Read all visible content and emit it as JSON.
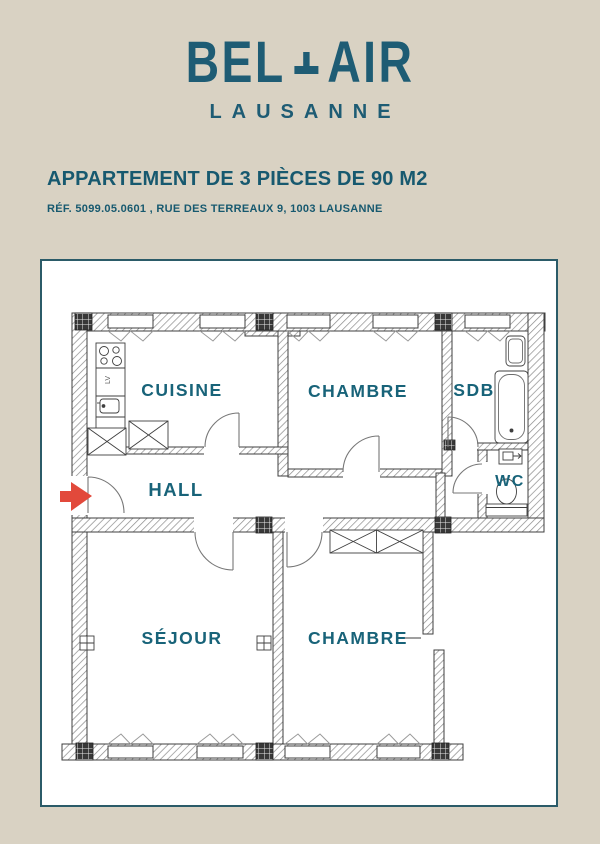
{
  "brand": {
    "name_left": "BEL",
    "name_right": "AIR",
    "city": "LAUSANNE"
  },
  "listing": {
    "title": "APPARTEMENT DE 3 PIÈCES DE 90 M2",
    "reference": "RÉF. 5099.05.0601 , RUE DES TERREAUX 9, 1003 LAUSANNE"
  },
  "plan": {
    "rooms": [
      {
        "id": "cuisine",
        "label": "CUISINE"
      },
      {
        "id": "chambre-1",
        "label": "CHAMBRE"
      },
      {
        "id": "sdb",
        "label": "SDB"
      },
      {
        "id": "hall",
        "label": "HALL"
      },
      {
        "id": "wc",
        "label": "WC"
      },
      {
        "id": "sejour",
        "label": "SÉJOUR"
      },
      {
        "id": "chambre-2",
        "label": "CHAMBRE"
      }
    ],
    "appliance_label": "LV"
  },
  "colors": {
    "page_bg": "#d9d2c3",
    "accent_teal": "#1e5c74",
    "panel_border": "#2b5b68",
    "panel_bg": "#ffffff",
    "arrow_red": "#e2493b",
    "plan_line": "#3f3f3f"
  }
}
